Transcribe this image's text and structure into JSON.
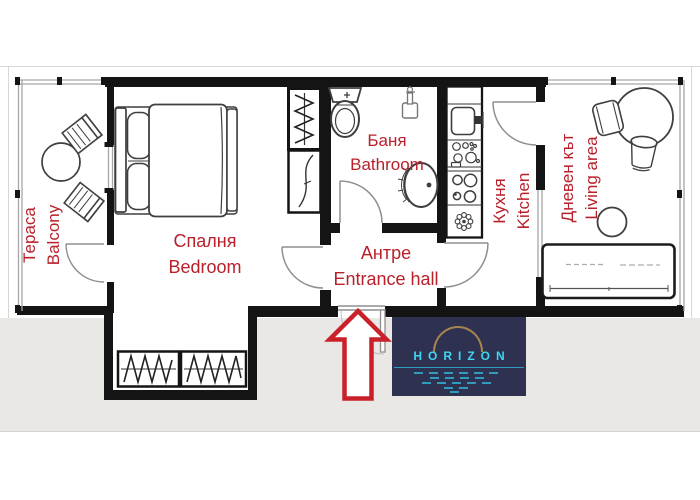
{
  "plan": {
    "type": "apartment-floor-plan",
    "label_color": "#b9202a",
    "wall_color": "#141414",
    "door_color": "#8f8f8f",
    "outside_band_color": "#e9e8e4",
    "rooms": {
      "balcony": {
        "bg": "Тераса",
        "en": "Balcony"
      },
      "bedroom": {
        "bg": "Спалня",
        "en": "Bedroom"
      },
      "bathroom": {
        "bg": "Баня",
        "en": "Bathroom"
      },
      "entrance": {
        "bg": "Антре",
        "en": "Entrance hall"
      },
      "kitchen": {
        "bg": "Кухня",
        "en": "Kitchen"
      },
      "living": {
        "bg": "Дневен кът",
        "en": "Living area"
      }
    },
    "entrance_arrow_color": "#c9202a"
  },
  "logo": {
    "text": "HORIZON",
    "background": "#2e3150",
    "text_color": "#3fd6f3",
    "arc_color": "#a8854f",
    "water_color": "#2f9cbd"
  }
}
